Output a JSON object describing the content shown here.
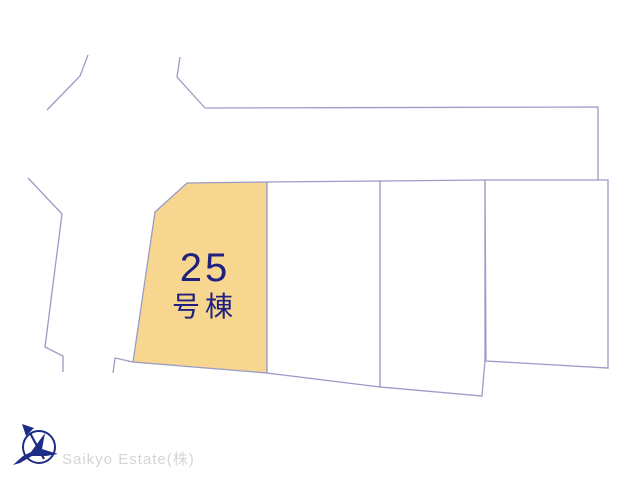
{
  "colors": {
    "background": "#ffffff",
    "boundary-line": "#9b9cc6",
    "lot-fill": "#f7d690",
    "lot-label": "#20207e",
    "logo-navy": "#1d2c85",
    "watermark": "#d5d5d5"
  },
  "plan": {
    "highlighted_lot": {
      "number": "25",
      "suffix": "号棟"
    },
    "lots": [
      {
        "id": "lot-25",
        "highlighted": true
      },
      {
        "id": "lot-2",
        "highlighted": false
      },
      {
        "id": "lot-3",
        "highlighted": false
      },
      {
        "id": "lot-4",
        "highlighted": false
      }
    ]
  },
  "footer": {
    "company": "Saikyo Estate(株)",
    "logo_icon": "bird-compass-logo"
  }
}
